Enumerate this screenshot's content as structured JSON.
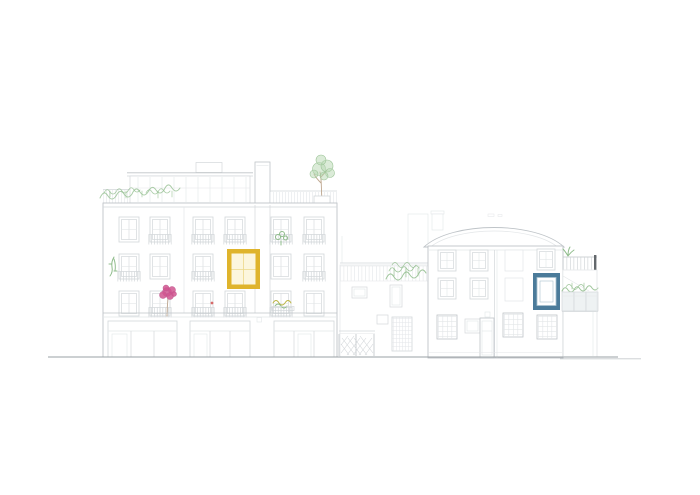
{
  "scene": {
    "kind": "architectural-street-elevation",
    "background": "#ffffff"
  },
  "colors": {
    "line_medium": "#bfc4c8",
    "line_light": "#d3d7da",
    "line_faint": "#e3e6e8",
    "ground_line": "#9aa0a4",
    "ground_line_light": "#c6cacd",
    "accent_yellow_frame": "#dfb42c",
    "accent_yellow_fill": "#fcf6dd",
    "accent_blue_frame": "#4b7b9a",
    "accent_blue_light": "#a9c2cf",
    "flower_pink": "#d0558f",
    "flower_red": "#d66a6a",
    "plant_green": "#8fbc8b",
    "plant_green_light": "#b7d7b2",
    "planter_yellow_green": "#bdb648",
    "railing_dark_post": "#63686c"
  }
}
